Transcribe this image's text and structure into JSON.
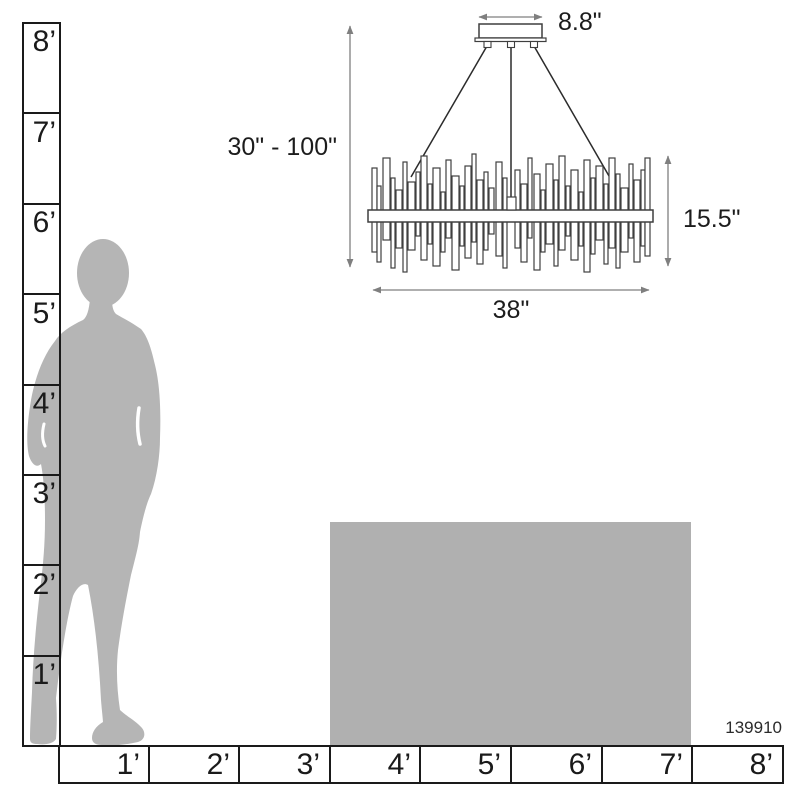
{
  "dimensions": {
    "canopy_width": "8.8\"",
    "suspension_height_range": "30\" - 100\"",
    "fixture_height": "15.5\"",
    "fixture_width": "38\""
  },
  "product_number": "139910",
  "vertical_ruler": {
    "labels": [
      "8’",
      "7’",
      "6’",
      "5’",
      "4’",
      "3’",
      "2’",
      "1’"
    ]
  },
  "horizontal_ruler": {
    "labels": [
      "1’",
      "2’",
      "3’",
      "4’",
      "5’",
      "6’",
      "7’",
      "8’"
    ]
  },
  "colors": {
    "figure_gray": "#b5b5b5",
    "furniture_gray": "#b0b0b0",
    "ruler_line": "#1a1a1a",
    "dimension_line": "#7f7f7f",
    "fixture_outline": "#3f3f3f"
  }
}
